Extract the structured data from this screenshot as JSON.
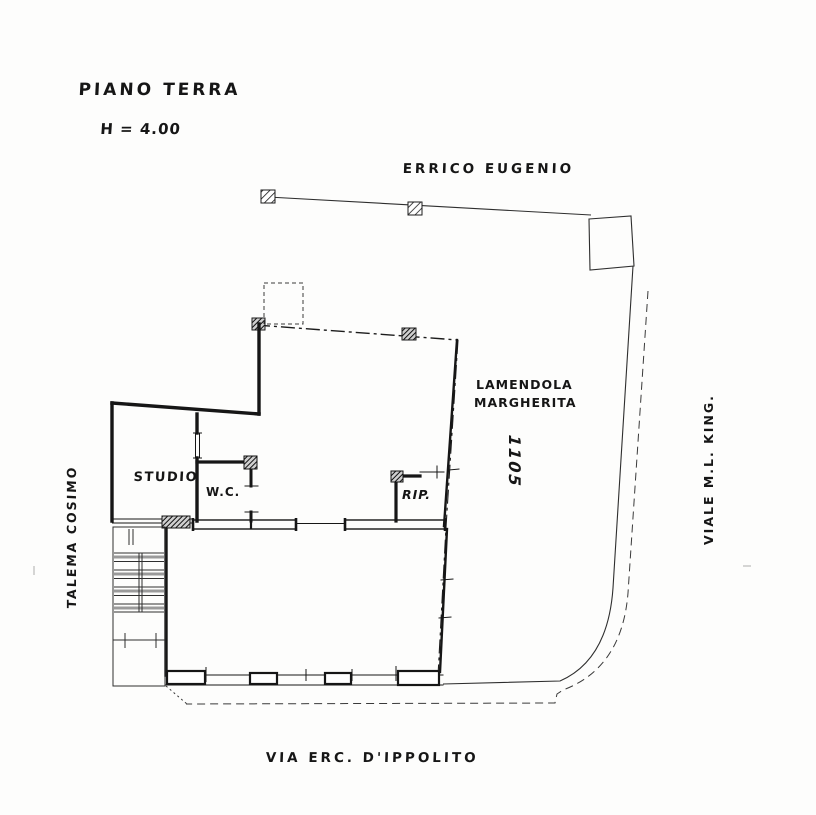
{
  "page": {
    "background": "#fdfdfc",
    "ink_color": "#1c1c1c"
  },
  "plan": {
    "title": "PIANO TERRA",
    "height_note": "H = 4.00",
    "neighbors": {
      "north": "ERRICO EUGENIO",
      "east_line1": "LAMENDOLA",
      "east_line2": "MARGHERITA",
      "west": "TALEMA COSIMO"
    },
    "parcel_number": "1105",
    "streets": {
      "east": "VIALE  M.L.  KING.",
      "south": "VIA  ERC.  D'IPPOLITO"
    },
    "rooms": [
      {
        "name": "STUDIO"
      },
      {
        "name": "W.C."
      },
      {
        "name": "RIP."
      }
    ]
  }
}
